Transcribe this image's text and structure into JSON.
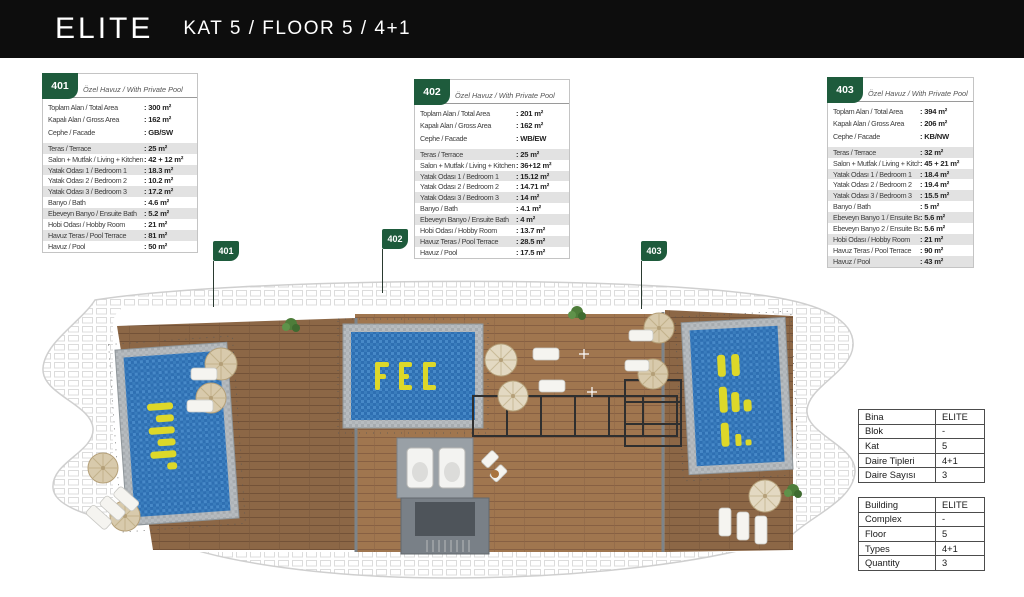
{
  "header": {
    "brand": "ELITE",
    "subtitle": "KAT 5 / FLOOR 5 / 4+1"
  },
  "colors": {
    "accent_green": "#1e5b3c",
    "header_bg": "#0d0d0d",
    "row_stripe": "#e2e2e2",
    "pool_blue": "#2e6fb2",
    "pool_logo_yellow": "#ddd829",
    "wood_brown": "#8c6746"
  },
  "units": [
    {
      "number": "401",
      "tag": "Özel Havuz / With Private Pool",
      "summary": [
        {
          "label": "Toplam Alan / Total Area",
          "value": "300 m²"
        },
        {
          "label": "Kapalı Alan / Gross Area",
          "value": "162 m²"
        },
        {
          "label": "Cephe / Facade",
          "value": "GB/SW"
        }
      ],
      "rooms": [
        {
          "label": "Teras / Terrace",
          "value": "25 m²"
        },
        {
          "label": "Salon + Mutfak / Living + Kitchen",
          "value": "42 + 12 m²"
        },
        {
          "label": "Yatak Odası 1 / Bedroom 1",
          "value": "18.3 m²"
        },
        {
          "label": "Yatak Odası 2 / Bedroom 2",
          "value": "10.2 m²"
        },
        {
          "label": "Yatak Odası 3 / Bedroom 3",
          "value": "17.2 m²"
        },
        {
          "label": "Banyo / Bath",
          "value": "4.6 m²"
        },
        {
          "label": "Ebeveyn Banyo / Ensuite Bath",
          "value": "5.2 m²"
        },
        {
          "label": "Hobi Odası / Hobby Room",
          "value": "21 m²"
        },
        {
          "label": "Havuz Teras / Pool Terrace",
          "value": "81 m²"
        },
        {
          "label": "Havuz / Pool",
          "value": "50 m²"
        }
      ]
    },
    {
      "number": "402",
      "tag": "Özel Havuz / With Private Pool",
      "summary": [
        {
          "label": "Toplam Alan / Total Area",
          "value": "201 m²"
        },
        {
          "label": "Kapalı Alan / Gross Area",
          "value": "162 m²"
        },
        {
          "label": "Cephe / Facade",
          "value": "WB/EW"
        }
      ],
      "rooms": [
        {
          "label": "Teras / Terrace",
          "value": "25 m²"
        },
        {
          "label": "Salon + Mutfak / Living + Kitchen",
          "value": "36+12 m²"
        },
        {
          "label": "Yatak Odası 1 / Bedroom 1",
          "value": "15.12 m²"
        },
        {
          "label": "Yatak Odası 2 / Bedroom 2",
          "value": "14.71 m²"
        },
        {
          "label": "Yatak Odası 3 / Bedroom 3",
          "value": "14 m²"
        },
        {
          "label": "Banyo / Bath",
          "value": "4.1 m²"
        },
        {
          "label": "Ebeveyn Banyo / Ensuite Bath",
          "value": "4 m²"
        },
        {
          "label": "Hobi Odası / Hobby Room",
          "value": "13.7 m²"
        },
        {
          "label": "Havuz Teras / Pool Terrace",
          "value": "28.5 m²"
        },
        {
          "label": "Havuz / Pool",
          "value": "17.5 m²"
        }
      ]
    },
    {
      "number": "403",
      "tag": "Özel Havuz / With Private Pool",
      "summary": [
        {
          "label": "Toplam Alan / Total Area",
          "value": "394 m²"
        },
        {
          "label": "Kapalı Alan / Gross Area",
          "value": "206 m²"
        },
        {
          "label": "Cephe / Facade",
          "value": "KB/NW"
        }
      ],
      "rooms": [
        {
          "label": "Teras / Terrace",
          "value": "32 m²"
        },
        {
          "label": "Salon + Mutfak / Living + Kitchen",
          "value": "45 + 21 m²"
        },
        {
          "label": "Yatak Odası 1 / Bedroom 1",
          "value": "18.4 m²"
        },
        {
          "label": "Yatak Odası 2 / Bedroom 2",
          "value": "19.4 m²"
        },
        {
          "label": "Yatak Odası 3 / Bedroom 3",
          "value": "15.5 m²"
        },
        {
          "label": "Banyo / Bath",
          "value": "5 m²"
        },
        {
          "label": "Ebeveyn Banyo 1 / Ensuite Bath 1",
          "value": "5.6 m²"
        },
        {
          "label": "Ebeveyn Banyo 2 / Ensuite Bath 2",
          "value": "5.6 m²"
        },
        {
          "label": "Hobi Odası / Hobby Room",
          "value": "21 m²"
        },
        {
          "label": "Havuz Teras / Pool Terrace",
          "value": "90 m²"
        },
        {
          "label": "Havuz / Pool",
          "value": "43 m²"
        }
      ]
    }
  ],
  "plan": {
    "flags": [
      "401",
      "402",
      "403"
    ]
  },
  "info_tables": {
    "tr": {
      "rows": [
        {
          "label": "Bina",
          "value": "ELITE"
        },
        {
          "label": "Blok",
          "value": "-"
        },
        {
          "label": "Kat",
          "value": "5"
        },
        {
          "label": "Daire Tipleri",
          "value": "4+1"
        },
        {
          "label": "Daire Sayısı",
          "value": "3"
        }
      ]
    },
    "en": {
      "rows": [
        {
          "label": "Building",
          "value": "ELITE"
        },
        {
          "label": "Complex",
          "value": "-"
        },
        {
          "label": "Floor",
          "value": "5"
        },
        {
          "label": "Types",
          "value": "4+1"
        },
        {
          "label": "Quantity",
          "value": "3"
        }
      ]
    }
  }
}
